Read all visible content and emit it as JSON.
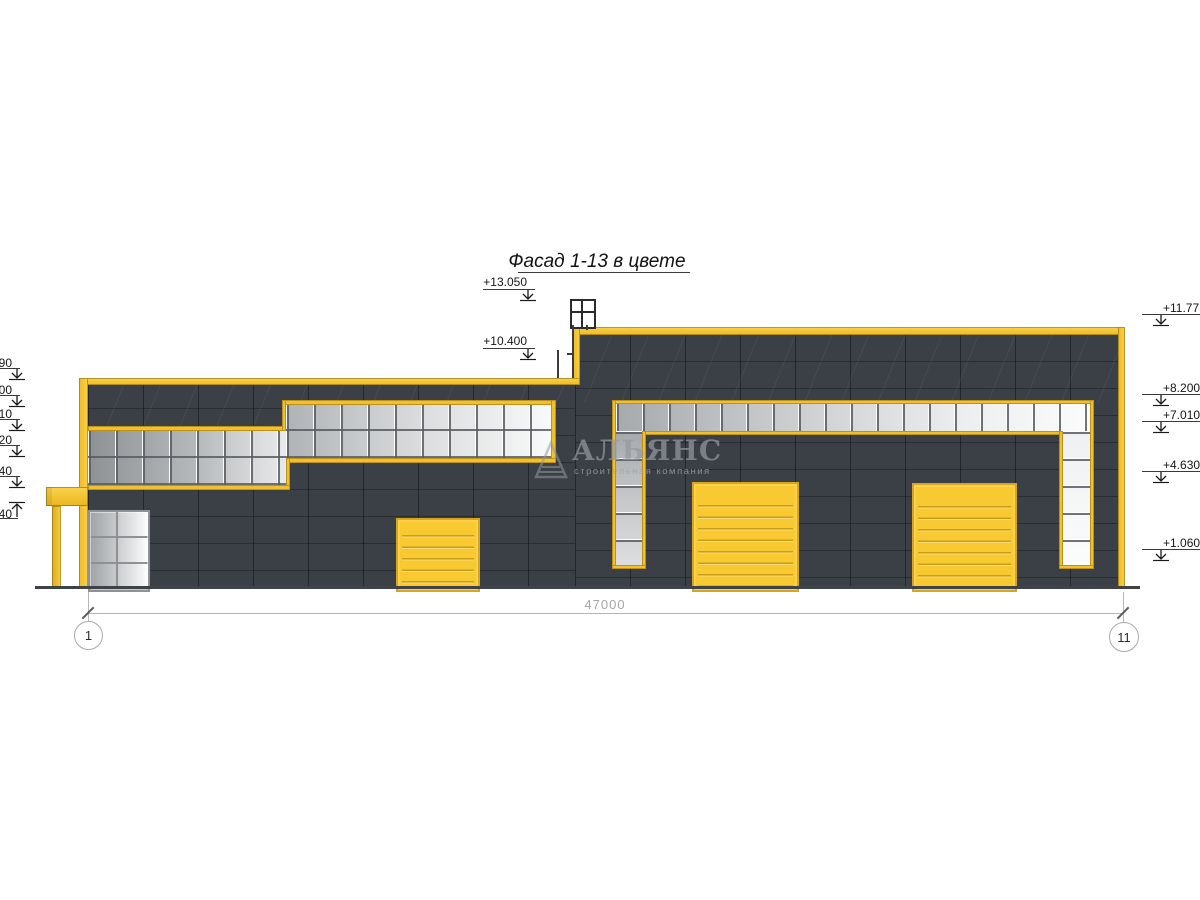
{
  "title": "Фасад 1-13 в цвете",
  "watermark": {
    "name": "АЛЬЯНС",
    "tagline": "строительная компания"
  },
  "dimension_total": "47000",
  "axis_left": "1",
  "axis_right": "11",
  "elevations": {
    "top_structure": "+13.050",
    "roof_main": "+10.400",
    "right": [
      "+11.77",
      "+8.200",
      "+7.010",
      "+4.630",
      "+1.060"
    ],
    "left_fragments": [
      "90",
      "00",
      "10",
      "20",
      "40",
      "40"
    ]
  },
  "colors": {
    "accent_yellow": "#F2C02A",
    "wall_dark": "#3B3F46"
  }
}
